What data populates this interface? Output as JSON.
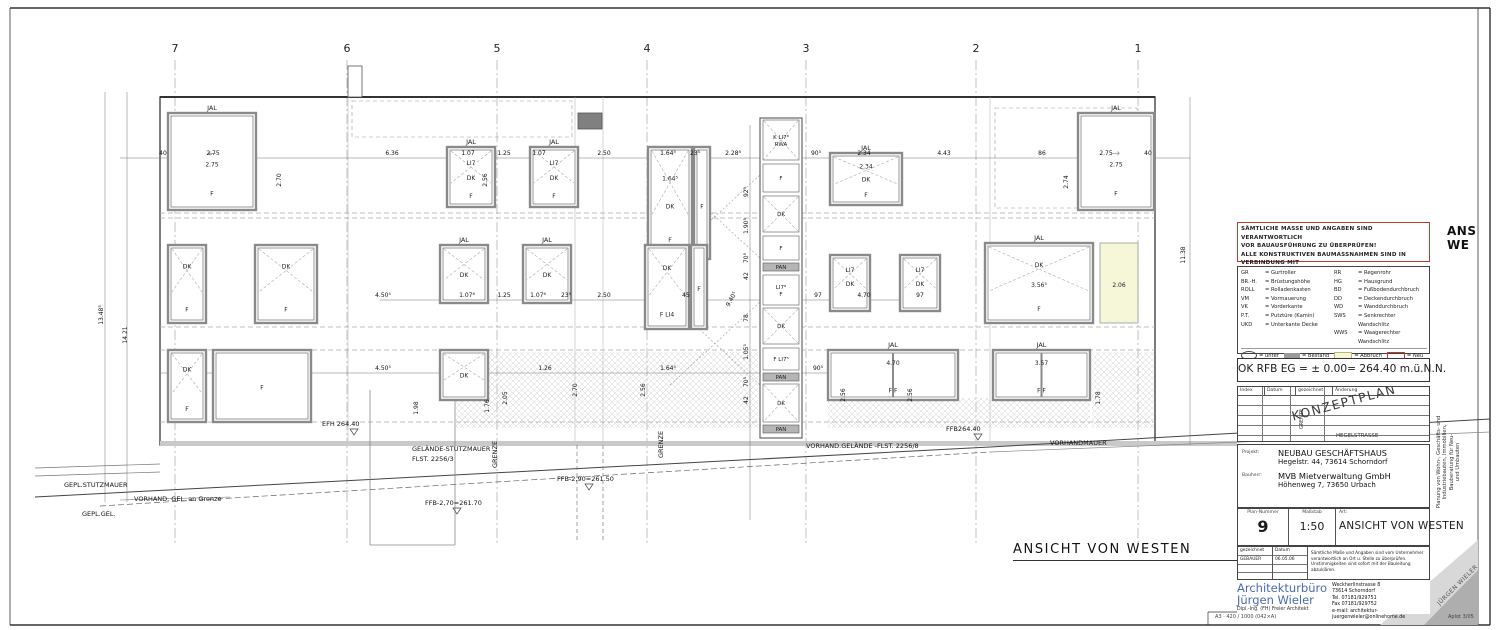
{
  "colors": {
    "accent_red": "#c23a2e",
    "brand_blue": "#4a6ab0",
    "abbruch_yellow": "#f6f6d8",
    "bestand_gray": "#9a9a9a"
  },
  "sheet": {
    "footer_left": "A3 · 420 / 1000 (042×A)",
    "footer_right": "Aplot 3/05"
  },
  "corner": {
    "l1": "ANS",
    "l2": "WE"
  },
  "fold_label": "JÜRGEN WIELER",
  "side_text": {
    "l1": "Planung von Wohn-, Geschäfts- und",
    "l2": "Industriebauten, Immobilien,",
    "l3": "Bauberatung für Neu-",
    "l4": "und Umbauten"
  },
  "warning": {
    "lines": [
      "SÄMTLICHE MASSE UND ANGABEN SIND VERANTWORTLICH",
      "VOR BAUAUSFÜHRUNG ZU ÜBERPRÜFEN!",
      "ALLE KONSTRUKTIVEN BAUMASSNAHMEN SIND IN VERBINDUNG MIT",
      "DEM STATIKER VOR ORT MIT DER BAULEITUNG ABZUKLÄREN!"
    ]
  },
  "legend": {
    "left": [
      {
        "abbr": "GR",
        "def": "= Gurtroller"
      },
      {
        "abbr": "BR.-H.",
        "def": "= Brüstungshöhe"
      },
      {
        "abbr": "ROLL",
        "def": "= Rolladenkasten"
      },
      {
        "abbr": "VM",
        "def": "= Vormauerung"
      },
      {
        "abbr": "VK",
        "def": "= Vorderkante"
      },
      {
        "abbr": "P.T.",
        "def": "= Putztüre (Kamin)"
      },
      {
        "abbr": "UKD",
        "def": "= Unterkante Decke"
      }
    ],
    "right": [
      {
        "abbr": "RR",
        "def": "= Regenrohr"
      },
      {
        "abbr": "HG",
        "def": "= Hausgrund"
      },
      {
        "abbr": "BD",
        "def": "= Fußbodendurchbruch"
      },
      {
        "abbr": "DD",
        "def": "= Deckendurchbruch"
      },
      {
        "abbr": "WD",
        "def": "= Wanddurchbruch"
      },
      {
        "abbr": "SWS",
        "def": "= Senkrechter Wandschlitz"
      },
      {
        "abbr": "WWS",
        "def": "= Waagerechter Wandschlitz"
      }
    ],
    "symbols": [
      {
        "label": "= unter"
      },
      {
        "label": "= Bestand"
      },
      {
        "label": "= Abbruch"
      },
      {
        "label": "= Neu"
      },
      {
        "label": "= Fundamenterder"
      }
    ]
  },
  "level_line": "OK RFB EG = ± 0.00= 264.40 m.ü.N.N.",
  "revision": {
    "headers": [
      "Index",
      "Datum",
      "gezeichnet",
      "Änderung"
    ],
    "stamp": "KONZEPTPLAN",
    "grenze": "GRENZE",
    "street": "HEGELSTRASSE"
  },
  "project": {
    "label": "Projekt:",
    "name": "NEUBAU GESCHÄFTSHAUS",
    "addr": "Hegelstr. 44, 73614 Schorndorf",
    "client_label": "Bauherr:",
    "client": "MVB Mietverwaltung GmbH",
    "client_addr": "Höhenweg 7, 73650 Urbach"
  },
  "plan": {
    "num_label": "Plan-Nummer",
    "num": "9",
    "scale_label": "Maßstab",
    "scale": "1:50",
    "type_label": "Art:",
    "type": "ANSICHT VON WESTEN"
  },
  "sign": {
    "gez_label": "gezeichnet",
    "gez": "GEBAUER",
    "date_label": "Datum",
    "date": "06.05.06",
    "note": [
      "Sämtliche Maße und Angaben sind vom Unternehmer",
      "verantwortlich an Ort u. Stelle zu überprüfen.",
      "Unstimmigkeiten sind sofort mit der Bauleitung abzuklären."
    ]
  },
  "architect": {
    "line1": "Architekturbüro",
    "line2": "Jürgen Wieler",
    "line3": "Dipl.-Ing. (FH) Freier Architekt",
    "addr": [
      "Weckherlinstrasse 8",
      "73614 Schorndorf",
      "Tel. 07181/929751",
      "Fax 07181/929752",
      "e-mail: architektur-juergenwieler@onlinehome.de"
    ]
  },
  "drawing": {
    "title": "ANSICHT VON WESTEN",
    "grid": {
      "labels": [
        "7",
        "6",
        "5",
        "4",
        "3",
        "2",
        "1"
      ],
      "x": [
        175,
        347,
        497,
        647,
        806,
        976,
        1138
      ]
    },
    "windows": [
      {
        "x": 168,
        "y": 113,
        "w": 88,
        "h": 97,
        "top": "JAL",
        "c": "2.75",
        "b": "F",
        "arrow": "←"
      },
      {
        "x": 447,
        "y": 147,
        "w": 48,
        "h": 60,
        "top": "JAL",
        "a": "LI7",
        "c": "DK",
        "b": "F",
        "xp": 1
      },
      {
        "x": 530,
        "y": 147,
        "w": 48,
        "h": 60,
        "top": "JAL",
        "a": "LI7",
        "c": "DK",
        "b": "F",
        "xp": 1
      },
      {
        "x": 648,
        "y": 147,
        "w": 44,
        "h": 112,
        "a": "1.64⁵",
        "c": "DK",
        "b": "F",
        "xp": 1
      },
      {
        "x": 694,
        "y": 147,
        "w": 16,
        "h": 112,
        "c": "F"
      },
      {
        "x": 830,
        "y": 153,
        "w": 72,
        "h": 52,
        "top": "JAL",
        "a": "2.34",
        "c": "DK",
        "b": "F",
        "xp": 1
      },
      {
        "x": 1078,
        "y": 113,
        "w": 76,
        "h": 97,
        "top": "JAL",
        "c": "2.75",
        "b": "F",
        "arrow": "→"
      },
      {
        "x": 168,
        "y": 245,
        "w": 38,
        "h": 78,
        "a": "DK",
        "b": "F",
        "xp": 1
      },
      {
        "x": 255,
        "y": 245,
        "w": 62,
        "h": 78,
        "a": "DK",
        "b": "F",
        "xp": 1
      },
      {
        "x": 440,
        "y": 245,
        "w": 48,
        "h": 58,
        "top": "JAL",
        "c": "DK",
        "xp": 1
      },
      {
        "x": 523,
        "y": 245,
        "w": 48,
        "h": 58,
        "top": "JAL",
        "c": "DK",
        "xp": 1
      },
      {
        "x": 645,
        "y": 245,
        "w": 44,
        "h": 84,
        "a": "DK",
        "b": "F LI4",
        "xp": 1
      },
      {
        "x": 691,
        "y": 245,
        "w": 16,
        "h": 84,
        "c": "F"
      },
      {
        "x": 830,
        "y": 255,
        "w": 40,
        "h": 56,
        "a": "LI7",
        "c": "DK",
        "xp": 1
      },
      {
        "x": 900,
        "y": 255,
        "w": 40,
        "h": 56,
        "a": "LI7",
        "c": "DK",
        "xp": 1
      },
      {
        "x": 985,
        "y": 243,
        "w": 108,
        "h": 80,
        "top": "JAL",
        "a": "DK",
        "c": "3.56⁵",
        "b": "F",
        "xp": 1
      },
      {
        "x": 1100,
        "y": 243,
        "w": 38,
        "h": 80,
        "c": "2.06",
        "fill": "#f6f6d8",
        "nb": 1
      },
      {
        "x": 168,
        "y": 350,
        "w": 38,
        "h": 72,
        "a": "DK",
        "b": "F",
        "xp": 1
      },
      {
        "x": 213,
        "y": 350,
        "w": 98,
        "h": 72,
        "c": "F"
      },
      {
        "x": 440,
        "y": 350,
        "w": 48,
        "h": 50,
        "c": "DK",
        "xp": 1
      },
      {
        "x": 828,
        "y": 350,
        "w": 130,
        "h": 50,
        "top": "JAL",
        "a": "4.70",
        "b": "F          F",
        "split": 1
      },
      {
        "x": 993,
        "y": 350,
        "w": 97,
        "h": 50,
        "top": "JAL",
        "a": "3.57",
        "b": "F       F",
        "split": 1
      }
    ],
    "stair_cells": [
      [
        "K LI7⁸|RWA",
        120,
        40,
        "x"
      ],
      [
        "F",
        164,
        28,
        ""
      ],
      [
        "DK",
        196,
        36,
        "x"
      ],
      [
        "F",
        236,
        24,
        ""
      ],
      [
        "PAN",
        263,
        8,
        "pan"
      ],
      [
        "LI7⁸|F",
        275,
        30,
        ""
      ],
      [
        "DK",
        308,
        36,
        "x"
      ],
      [
        "F LI7⁵",
        348,
        22,
        ""
      ],
      [
        "PAN",
        373,
        8,
        "pan"
      ],
      [
        "DK",
        384,
        38,
        "x"
      ],
      [
        "PAN",
        425,
        8,
        "pan"
      ]
    ],
    "dims": [
      [
        "40",
        163,
        155
      ],
      [
        "2.75",
        213,
        155
      ],
      [
        "6.36",
        392,
        155
      ],
      [
        "1.07",
        468,
        155
      ],
      [
        "1.25",
        504,
        155
      ],
      [
        "1.07",
        539,
        155
      ],
      [
        "2.50",
        604,
        155
      ],
      [
        "1.64⁵",
        668,
        155
      ],
      [
        "23⁵",
        695,
        155
      ],
      [
        "2.28⁸",
        733,
        155
      ],
      [
        "90⁵",
        816,
        155
      ],
      [
        "2.34",
        864,
        155
      ],
      [
        "4.43",
        944,
        155
      ],
      [
        "86",
        1042,
        155
      ],
      [
        "2.75",
        1106,
        155
      ],
      [
        "40",
        1148,
        155
      ],
      [
        "4.50⁵",
        383,
        297
      ],
      [
        "1.07⁶",
        467,
        297
      ],
      [
        "1.25",
        504,
        297
      ],
      [
        "1.07⁶",
        538,
        297
      ],
      [
        "23⁵",
        566,
        297
      ],
      [
        "2.50",
        604,
        297
      ],
      [
        "45",
        686,
        297
      ],
      [
        "97",
        818,
        297
      ],
      [
        "4.70",
        864,
        297
      ],
      [
        "97",
        920,
        297
      ],
      [
        "4.50⁵",
        383,
        370
      ],
      [
        "1.26",
        545,
        370
      ],
      [
        "1.64⁵",
        668,
        370
      ],
      [
        "90⁵",
        818,
        370
      ],
      [
        "13.48⁵",
        103,
        315,
        -90
      ],
      [
        "14.21",
        127,
        335,
        -90
      ],
      [
        "11.38",
        1185,
        255,
        -90
      ],
      [
        "2.70",
        281,
        180,
        -90
      ],
      [
        "2.56",
        487,
        180,
        -90
      ],
      [
        "2.74",
        1068,
        182,
        -90
      ],
      [
        "2.70",
        577,
        390,
        -90
      ],
      [
        "2.56",
        645,
        390,
        -90
      ],
      [
        "2.56",
        845,
        395,
        -90
      ],
      [
        "2.56",
        912,
        395,
        -90
      ],
      [
        "1.78",
        1100,
        398,
        -90
      ],
      [
        "1.98",
        418,
        408,
        -90
      ],
      [
        "1.76",
        489,
        406,
        -90
      ],
      [
        "2.05",
        507,
        398,
        -90
      ],
      [
        "92⁵",
        748,
        192,
        -90
      ],
      [
        "1.90⁵",
        748,
        226,
        -90
      ],
      [
        "70⁵",
        748,
        258,
        -90
      ],
      [
        "42",
        748,
        276,
        -90
      ],
      [
        "9.40⁵",
        733,
        300,
        -62
      ],
      [
        "78",
        748,
        318,
        -90
      ],
      [
        "1.05⁵",
        748,
        352,
        -90
      ],
      [
        "70⁵",
        748,
        382,
        -90
      ],
      [
        "42",
        748,
        400,
        -90
      ]
    ],
    "annotations": [
      {
        "t": "EFH 264.40",
        "x": 322,
        "y": 426,
        "lvl": 1
      },
      {
        "t": "FFB264.40",
        "x": 946,
        "y": 431,
        "lvl": 1
      },
      {
        "t": "GELÄNDE-STUTZMAUER",
        "x": 412,
        "y": 451
      },
      {
        "t": "FLST. 2256/3",
        "x": 412,
        "y": 461
      },
      {
        "t": "GRENZE",
        "x": 497,
        "y": 468,
        "r": -90
      },
      {
        "t": "GRENZE",
        "x": 663,
        "y": 458,
        "r": -90
      },
      {
        "t": "FFB-2,90=261.50",
        "x": 557,
        "y": 481,
        "lvl": 1
      },
      {
        "t": "FFB-2,70=261.70",
        "x": 425,
        "y": 505,
        "lvl": 1
      },
      {
        "t": "VORHAND.GELÄNDE -FLST. 2256/8",
        "x": 806,
        "y": 448
      },
      {
        "t": "VORHANDMAUER",
        "x": 1050,
        "y": 445
      },
      {
        "t": "GEPL.STUTZMAUER",
        "x": 64,
        "y": 487
      },
      {
        "t": "VORHAND. GEL. an Grenze",
        "x": 134,
        "y": 501
      },
      {
        "t": "GEPL.GEL.",
        "x": 82,
        "y": 516
      }
    ]
  }
}
